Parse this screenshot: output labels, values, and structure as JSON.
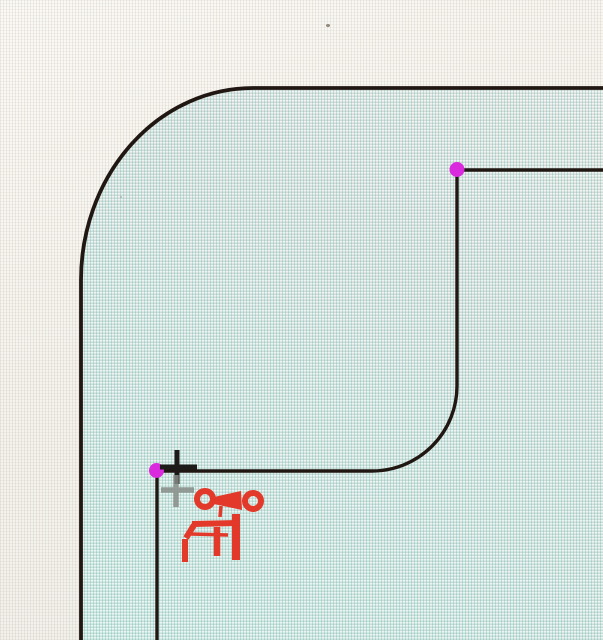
{
  "scene": {
    "type": "cad-sketch-viewport",
    "description": "Zoomed CAD part face with a sketched stepped corner profile; a fillet arc joins the vertical and horizontal step edges; two sketch endpoints are highlighted in magenta and the red sketch-fillet tool cursor with snap crosshair is shown",
    "colors": {
      "paper": "#f6f3ed",
      "face_top": "#e9e9e6",
      "face_bottom": "#d6ece6",
      "sketch_line": "#211712",
      "vertex_magenta": "#da2add",
      "tool_red": "#e2392a",
      "crosshair_black": "#1d1b19",
      "crosshair_gray": "#868c87"
    },
    "vertices": [
      {
        "name": "endpoint-top-right",
        "x": 457,
        "y": 169.5
      },
      {
        "name": "endpoint-bottom-left",
        "x": 156.5,
        "y": 470.5
      }
    ],
    "cursor": {
      "name": "fillet-tool-cursor",
      "x": 177,
      "y": 467
    }
  }
}
